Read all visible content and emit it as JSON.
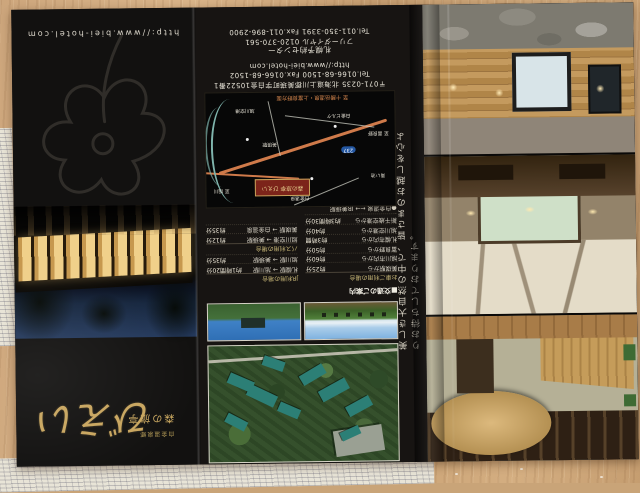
{
  "colors": {
    "logo_gold": "#c8a55e",
    "road_orange": "#cf7a4a",
    "river_teal": "#7fb4ac",
    "marker_red": "#7c241a",
    "route_badge_blue": "#2457a2"
  },
  "cover": {
    "logo_script": "びえい",
    "logo_name": "森の旅亭",
    "logo_sub": "白金温泉郷",
    "url": "http://www.biei-hotel.com"
  },
  "info": {
    "contact": {
      "address": "〒071-0235 北海道上川郡美瑛町字白金10522番1",
      "telfax": "Tel.0166-68-1500 Fax.0166-68-1502",
      "url": "http://www.biei-hotel.com",
      "center": "札幌予約センター",
      "tollfree": "フリーダイヤル 0120-370-561",
      "telfax2": "Tel.011-350-3391 Fax.011-896-2900"
    },
    "access": {
      "title": "■交通のご案内",
      "col_car": "お車ご利用の場合",
      "car": [
        {
          "route": "美瑛駅から",
          "time": "約25分"
        },
        {
          "route": "旭川市内から",
          "time": "約60分"
        },
        {
          "route": "富良野から",
          "time": "約50分"
        },
        {
          "route": "札幌市内から",
          "time": "約3時間"
        },
        {
          "route": "旭川空港から",
          "time": "約40分"
        },
        {
          "route": "新千歳空港から",
          "time": "約3時間30分"
        }
      ],
      "jr_header": "JR利用の場合",
      "jr": [
        {
          "route": "札幌駅 → 旭川駅",
          "time": "約1時間20分"
        },
        {
          "route": "旭川駅 → 美瑛駅",
          "time": "約35分"
        }
      ],
      "bus_header": "バス利用の場合",
      "bus": [
        {
          "route": "旭川空港 → 美瑛駅",
          "time": "約12分"
        },
        {
          "route": "美瑛駅 → 白金温泉",
          "time": "約35分"
        }
      ],
      "note1": "●白金温泉 ←→ JR美瑛駅",
      "note2": "■無料送迎運行中（要事前予約）"
    },
    "map": {
      "caption": "至 十勝岳温泉・上富良野方面",
      "badge": "237",
      "logo": "森の旅亭 びえい",
      "labels": [
        "白金温泉",
        "青い池",
        "白金ビルケ",
        "美瑛駅",
        "至 旭川",
        "至 富良野",
        "旭川空港"
      ]
    }
  },
  "gallery": {
    "catchphrase": "美しき大自然の中で、皆さまのお越しを心よりお待ちしております。"
  }
}
